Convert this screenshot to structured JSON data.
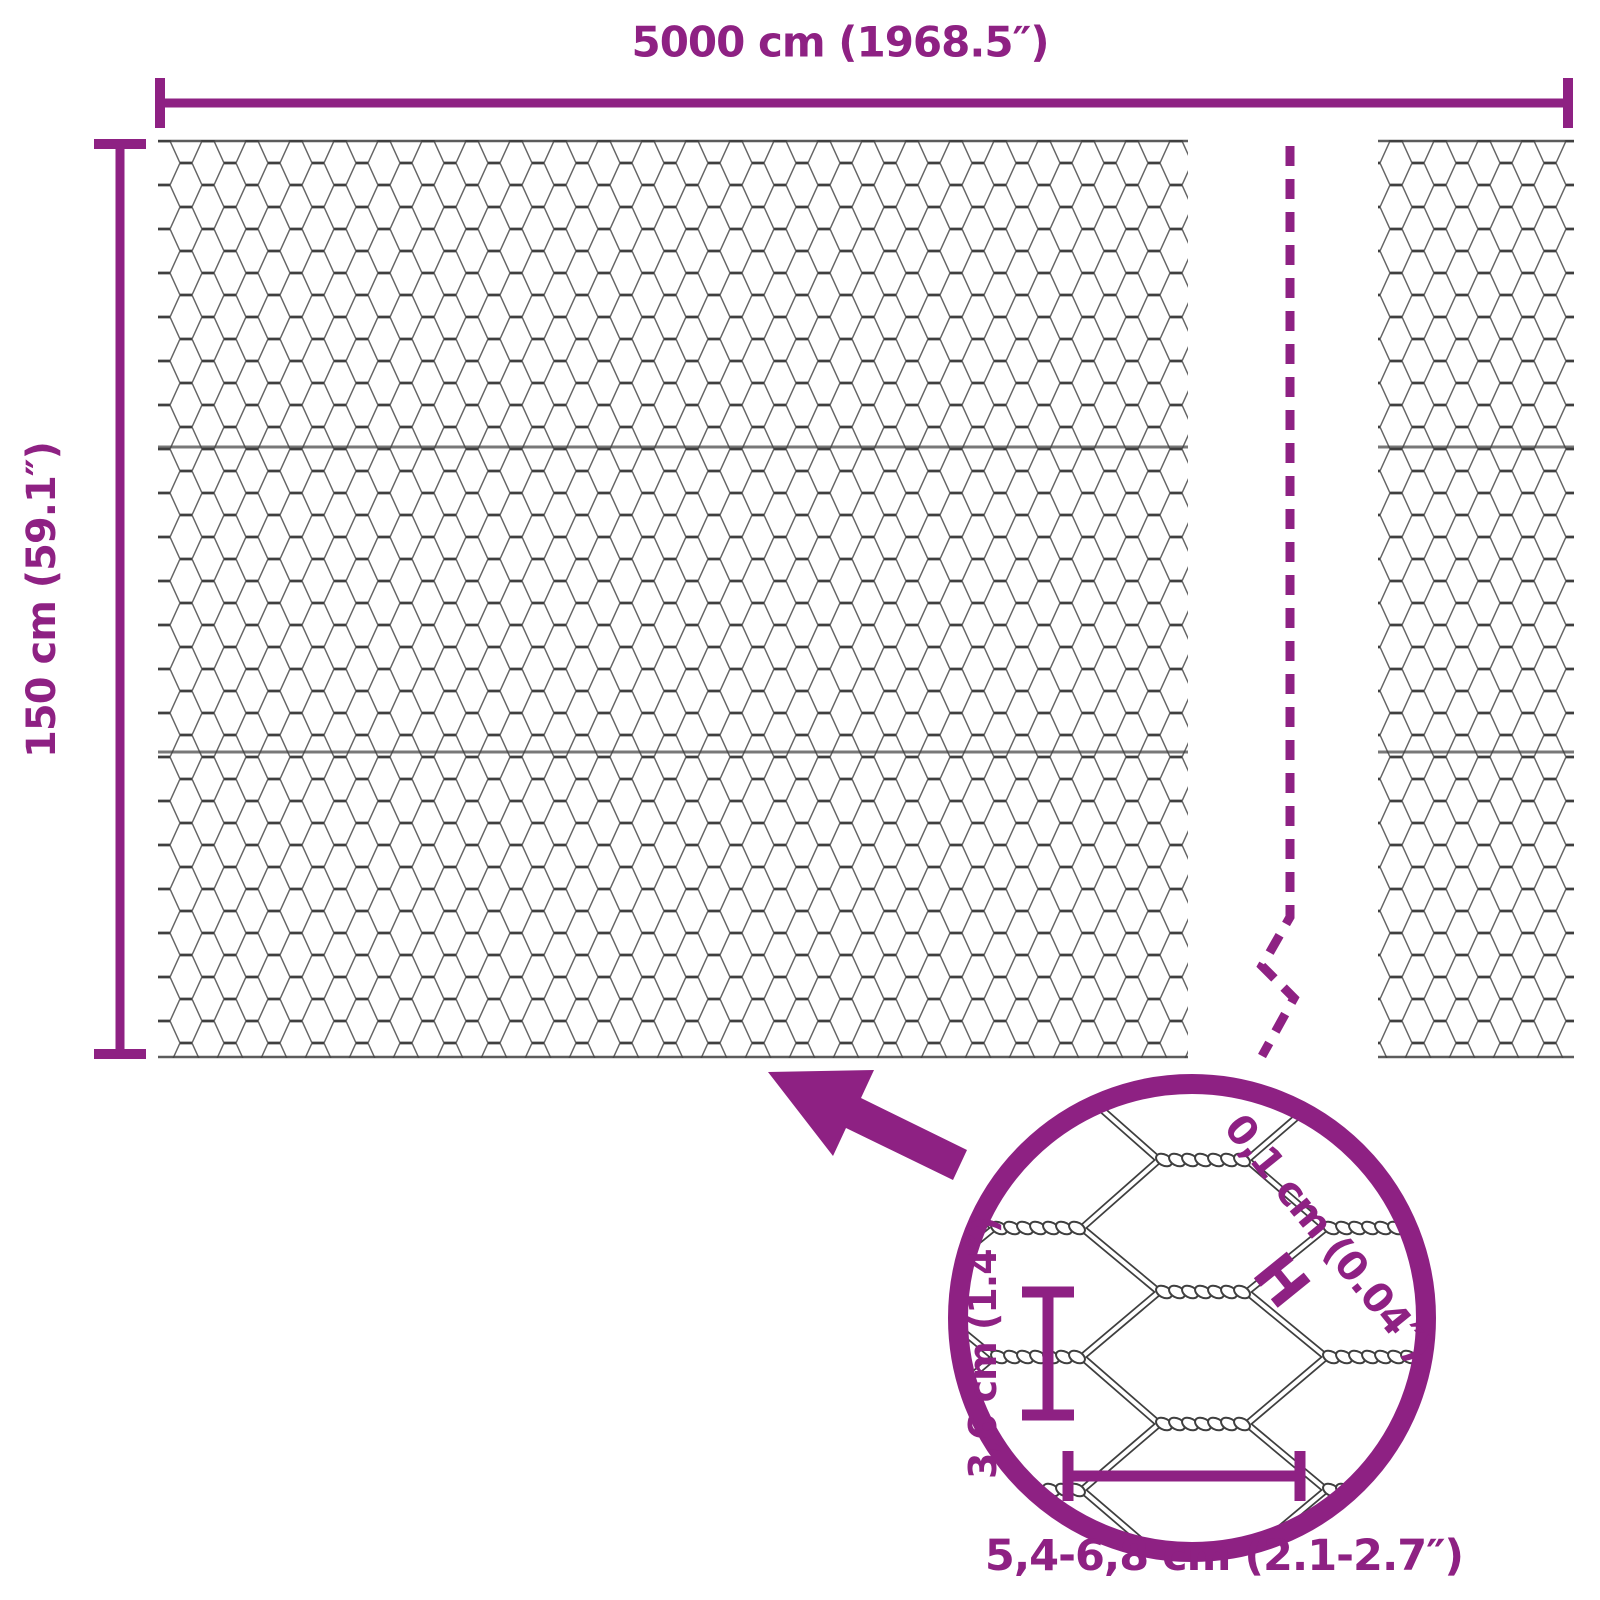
{
  "diagram": {
    "width_label": "5000 cm (1968.5″)",
    "height_label": "150 cm (59.1″)",
    "detail": {
      "opening_height_label": "3,6 cm (1.4″)",
      "opening_width_label": "5,4-6,8 cm (2.1-2.7″)",
      "wire_thickness_label": "0,1 cm (0.04″)",
      "wire_thickness_marker": "H"
    },
    "colors": {
      "accent": "#8E2183",
      "wire": "#3F3F3F"
    }
  }
}
